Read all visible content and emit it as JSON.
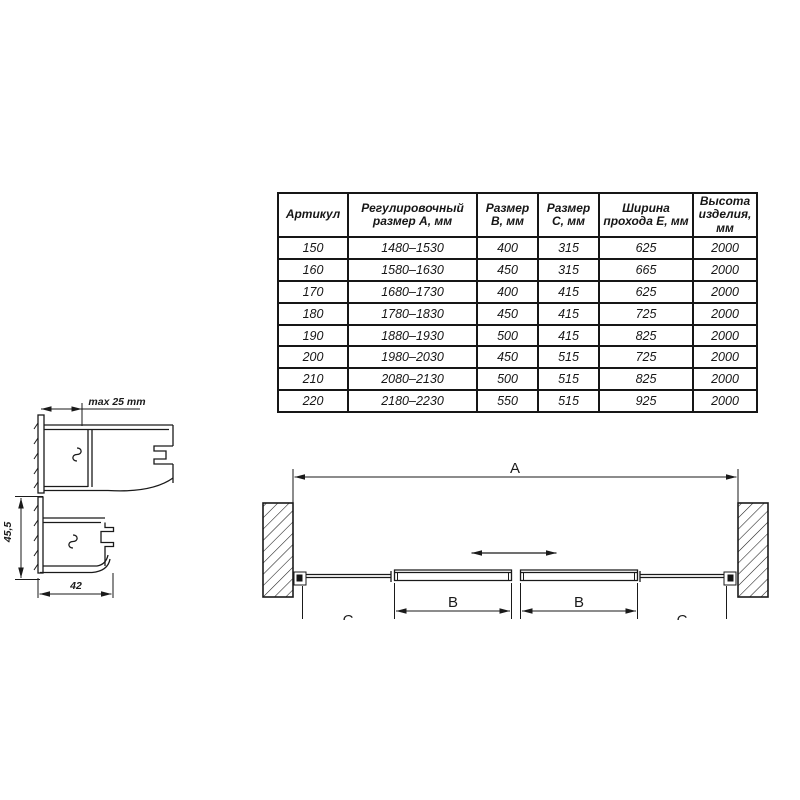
{
  "colors": {
    "line": "#1a1a1a",
    "background": "#ffffff"
  },
  "table": {
    "headers": [
      "Артикул",
      "Регулировочный размер А, мм",
      "Размер В, мм",
      "Размер С, мм",
      "Ширина прохода Е, мм",
      "Высота изделия, мм"
    ],
    "rows": [
      [
        "150",
        "1480–1530",
        "400",
        "315",
        "625",
        "2000"
      ],
      [
        "160",
        "1580–1630",
        "450",
        "315",
        "665",
        "2000"
      ],
      [
        "170",
        "1680–1730",
        "400",
        "415",
        "625",
        "2000"
      ],
      [
        "180",
        "1780–1830",
        "450",
        "415",
        "725",
        "2000"
      ],
      [
        "190",
        "1880–1930",
        "500",
        "415",
        "825",
        "2000"
      ],
      [
        "200",
        "1980–2030",
        "450",
        "515",
        "725",
        "2000"
      ],
      [
        "210",
        "2080–2130",
        "500",
        "515",
        "825",
        "2000"
      ],
      [
        "220",
        "2180–2230",
        "550",
        "515",
        "925",
        "2000"
      ]
    ]
  },
  "profiles": {
    "adjustment_label": "max 25 mm",
    "depth_label": "45,5",
    "width_label": "42"
  },
  "plan": {
    "overall_width_label": "A",
    "door_labels": [
      "B",
      "B"
    ],
    "side_labels": [
      "C",
      "C"
    ]
  }
}
